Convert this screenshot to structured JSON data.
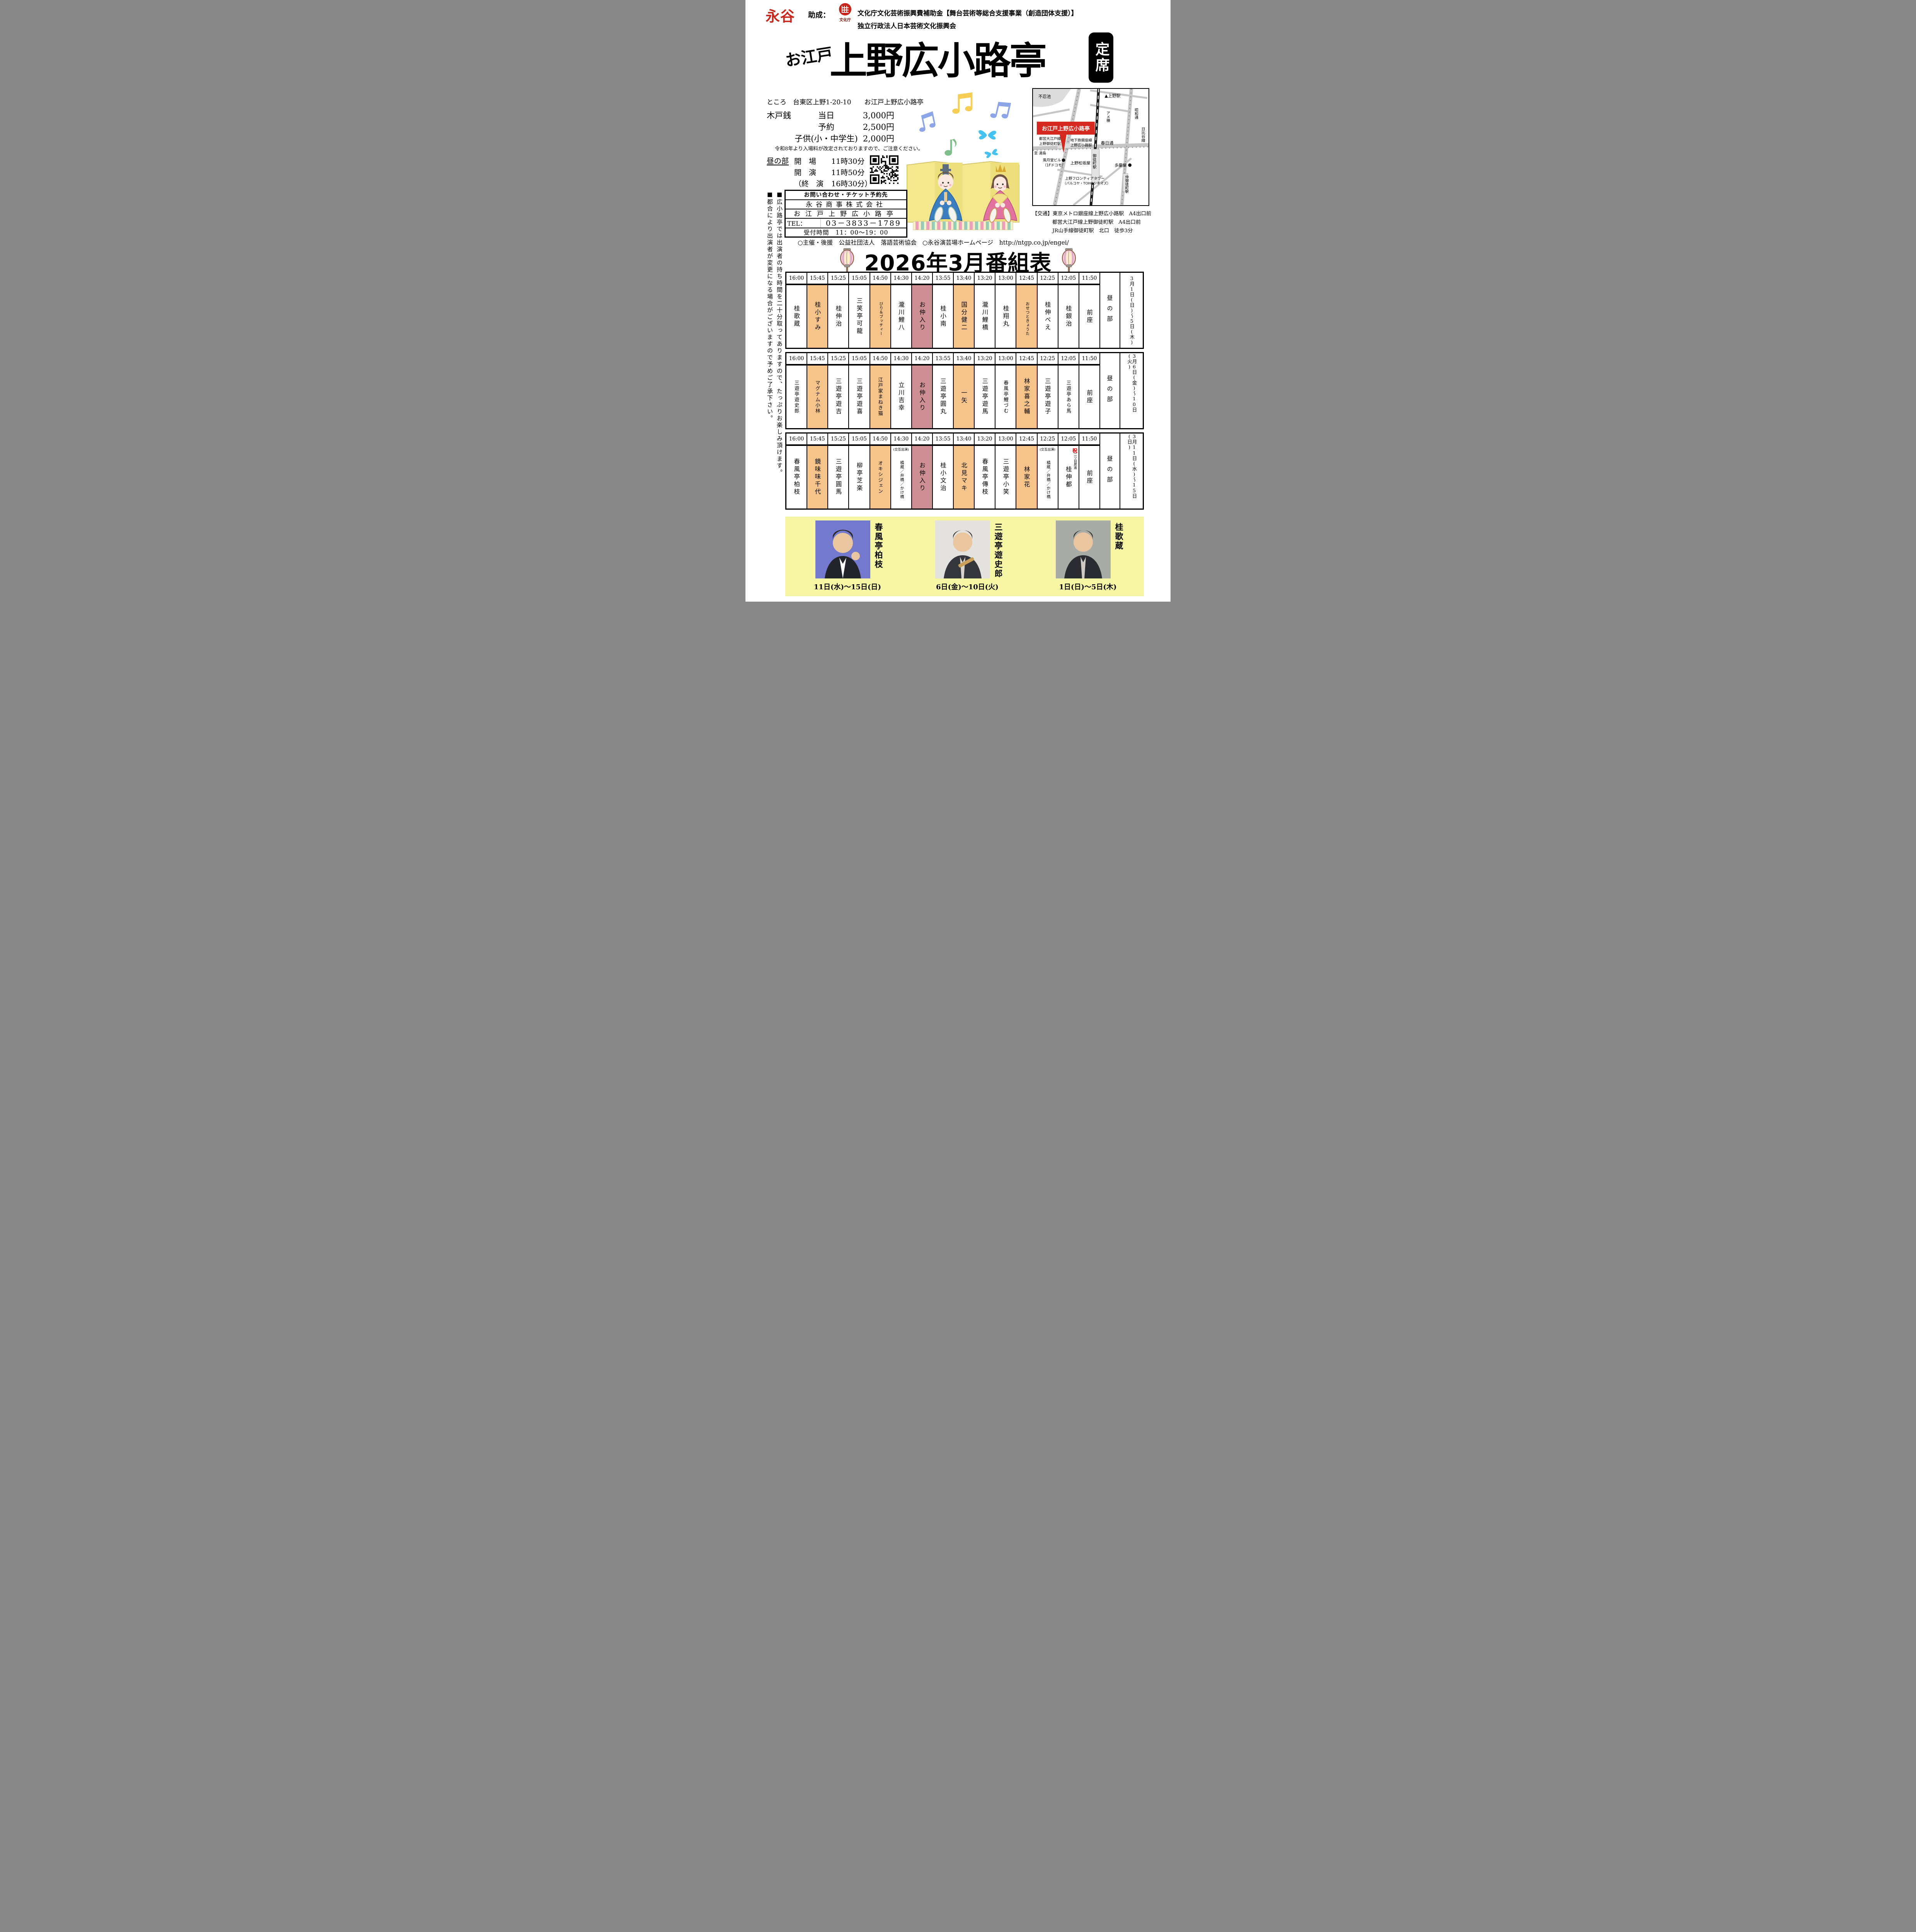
{
  "header": {
    "logo": "永谷",
    "grant_label": "助成：",
    "agency_name": "文化庁",
    "funding_line1": "文化庁文化芸術振興費補助金【舞台芸術等総合支援事業（創造団体支援）】",
    "funding_line2": "独立行政法人日本芸術文化振興会"
  },
  "title": {
    "prefix": "お江戸",
    "main": "上野広小路亭",
    "badge": "定席"
  },
  "info": {
    "venue_line": "ところ　台東区上野1-20-10　　お江戸上野広小路亭",
    "price_label": "木戸銭",
    "prices": [
      {
        "label": "当日",
        "value": "3,000円"
      },
      {
        "label": "予約",
        "value": "2,500円"
      },
      {
        "label": "子供(小・中学生)",
        "value": "2,000円"
      }
    ],
    "price_note": "令和8年より入場料が改定されておりますので、ご注意ください。",
    "session_label": "昼の部",
    "showtimes": [
      {
        "label": "開　場",
        "value": "11時30分"
      },
      {
        "label": "開　演",
        "value": "11時50分"
      },
      {
        "label": "（終　演",
        "value": "16時30分）"
      }
    ]
  },
  "contact": {
    "title": "お問い合わせ・チケット予約先",
    "company": "永谷商事株式会社",
    "venue": "お江戸上野広小路亭",
    "tel_label": "TEL：",
    "tel": "03－3833－1789",
    "hours_label": "受付時間",
    "hours": "11：00～19：00"
  },
  "map": {
    "pond": "不忍池",
    "ueno_station": "▲上野駅",
    "ameyoko": "アメ横",
    "showa_dori": "昭和通",
    "hibiya_line": "日比谷線",
    "venue_box": "お江戸上野広小路亭",
    "oedo_line": "都営大江戸線",
    "ueno_okachimachi_station": "上野御徒町駅",
    "ginza_line": "地下鉄銀座線",
    "ueno_hirokoji_station": "上野広小路駅",
    "to_yushima": "至 湯島",
    "kasuga_dori": "春日通",
    "fugetsudo": "風月堂ビル",
    "fugetsudo_note": "（1Fドコモ）",
    "matsuzakaya": "上野松坂屋",
    "okachimachi_station": "御徒町駅",
    "takeya": "多慶屋",
    "frontier_tower": "上野フロンティアタワー",
    "frontier_note": "（パルコヤ・TOHOシネマズ）",
    "naka_okachimachi_station": "仲御徒町駅"
  },
  "access": {
    "heading": "【交通】",
    "lines": [
      "東京メトロ銀座線上野広小路駅　A4出口前",
      "都営大江戸線上野御徒町駅　A4出口前",
      "JR山手線御徒町駅　北口　徒歩3分"
    ]
  },
  "organizer_line": "○主催・後援　公益社団法人　落語芸術協会",
  "website_line": "○永谷演芸場ホームページ　http://ntgp.co.jp/engei/",
  "notices": [
    "■広小路亭では出演者の持ち時間を二十分取ってありますので、たっぷりお楽しみ頂けます。",
    "■都合により出演者が変更になる場合がございますので予めご了承下さい。"
  ],
  "program_title": "2026年3月番組表",
  "schedule": {
    "session_label": "昼の部",
    "times": [
      "16:00",
      "15:45",
      "15:25",
      "15:05",
      "14:50",
      "14:30",
      "14:20",
      "13:55",
      "13:40",
      "13:20",
      "13:00",
      "12:45",
      "12:25",
      "12:05",
      "11:50"
    ],
    "blocks": [
      {
        "date": "3月1日(日)～5日(木)",
        "cells": [
          {
            "name": "桂歌蔵"
          },
          {
            "name": "桂小すみ",
            "highlight": true
          },
          {
            "name": "桂伸治"
          },
          {
            "name": "三笑亭可龍"
          },
          {
            "name": "びり＆ブッチィー",
            "highlight": true
          },
          {
            "name": "瀧川鯉八"
          },
          {
            "name": "お仲入り",
            "brk": true
          },
          {
            "name": "桂小南"
          },
          {
            "name": "国分健二",
            "highlight": true
          },
          {
            "name": "瀧川鯉橋"
          },
          {
            "name": "桂翔丸"
          },
          {
            "name": "おせつときょうた",
            "highlight": true
          },
          {
            "name": "桂伸べえ"
          },
          {
            "name": "桂銀治"
          },
          {
            "name": "前座"
          }
        ]
      },
      {
        "date": "3月6日(金)～10日(火)",
        "cells": [
          {
            "name": "三遊亭遊史郎"
          },
          {
            "name": "マグナム小林",
            "highlight": true
          },
          {
            "name": "三遊亭遊吉"
          },
          {
            "name": "三遊亭遊喜"
          },
          {
            "name": "江戸家まねき猫",
            "highlight": true
          },
          {
            "name": "立川吉幸"
          },
          {
            "name": "お仲入り",
            "brk": true
          },
          {
            "name": "三遊亭圓丸"
          },
          {
            "name": "一矢",
            "highlight": true
          },
          {
            "name": "三遊亭遊馬"
          },
          {
            "name": "春風亭鯉づむ"
          },
          {
            "name": "林家喜之輔",
            "highlight": true
          },
          {
            "name": "三遊亭遊子"
          },
          {
            "name": "三遊亭あら馬"
          },
          {
            "name": "前座"
          }
        ]
      },
      {
        "date": "3月11日(水)～15日(日)",
        "cells": [
          {
            "name": "春風亭柏枝"
          },
          {
            "name": "鏡味味千代",
            "highlight": true
          },
          {
            "name": "三遊亭圓馬"
          },
          {
            "name": "柳亭芝楽"
          },
          {
            "name": "オキシジェン",
            "highlight": true
          },
          {
            "name": "橘蔵／弁橋／かけ橋",
            "note": "(交互出演)"
          },
          {
            "name": "お仲入り",
            "brk": true
          },
          {
            "name": "桂小文治"
          },
          {
            "name": "北見マキ",
            "highlight": true
          },
          {
            "name": "春風亭傳枝"
          },
          {
            "name": "三遊亭小笑"
          },
          {
            "name": "林家花",
            "highlight": true
          },
          {
            "name": "橘蔵／弁橋／かけ橋",
            "note": "(交互出演)"
          },
          {
            "name": "桂伸都",
            "mark": "祝",
            "mark_note": "二ツ目昇進"
          },
          {
            "name": "前座"
          }
        ]
      }
    ]
  },
  "featured": [
    {
      "name": "春風亭柏枝",
      "dates": "11日(水)～15日(日)"
    },
    {
      "name": "三遊亭遊史郎",
      "dates": "6日(金)～10日(火)"
    },
    {
      "name": "桂歌蔵",
      "dates": "1日(日)～5日(木)"
    }
  ],
  "colors": {
    "highlight": "#F6C38A",
    "interval": "#CD8E94",
    "strip_bg": "#F6F6A4",
    "accent_red": "#D5281E",
    "logo_red": "#C8251D"
  }
}
